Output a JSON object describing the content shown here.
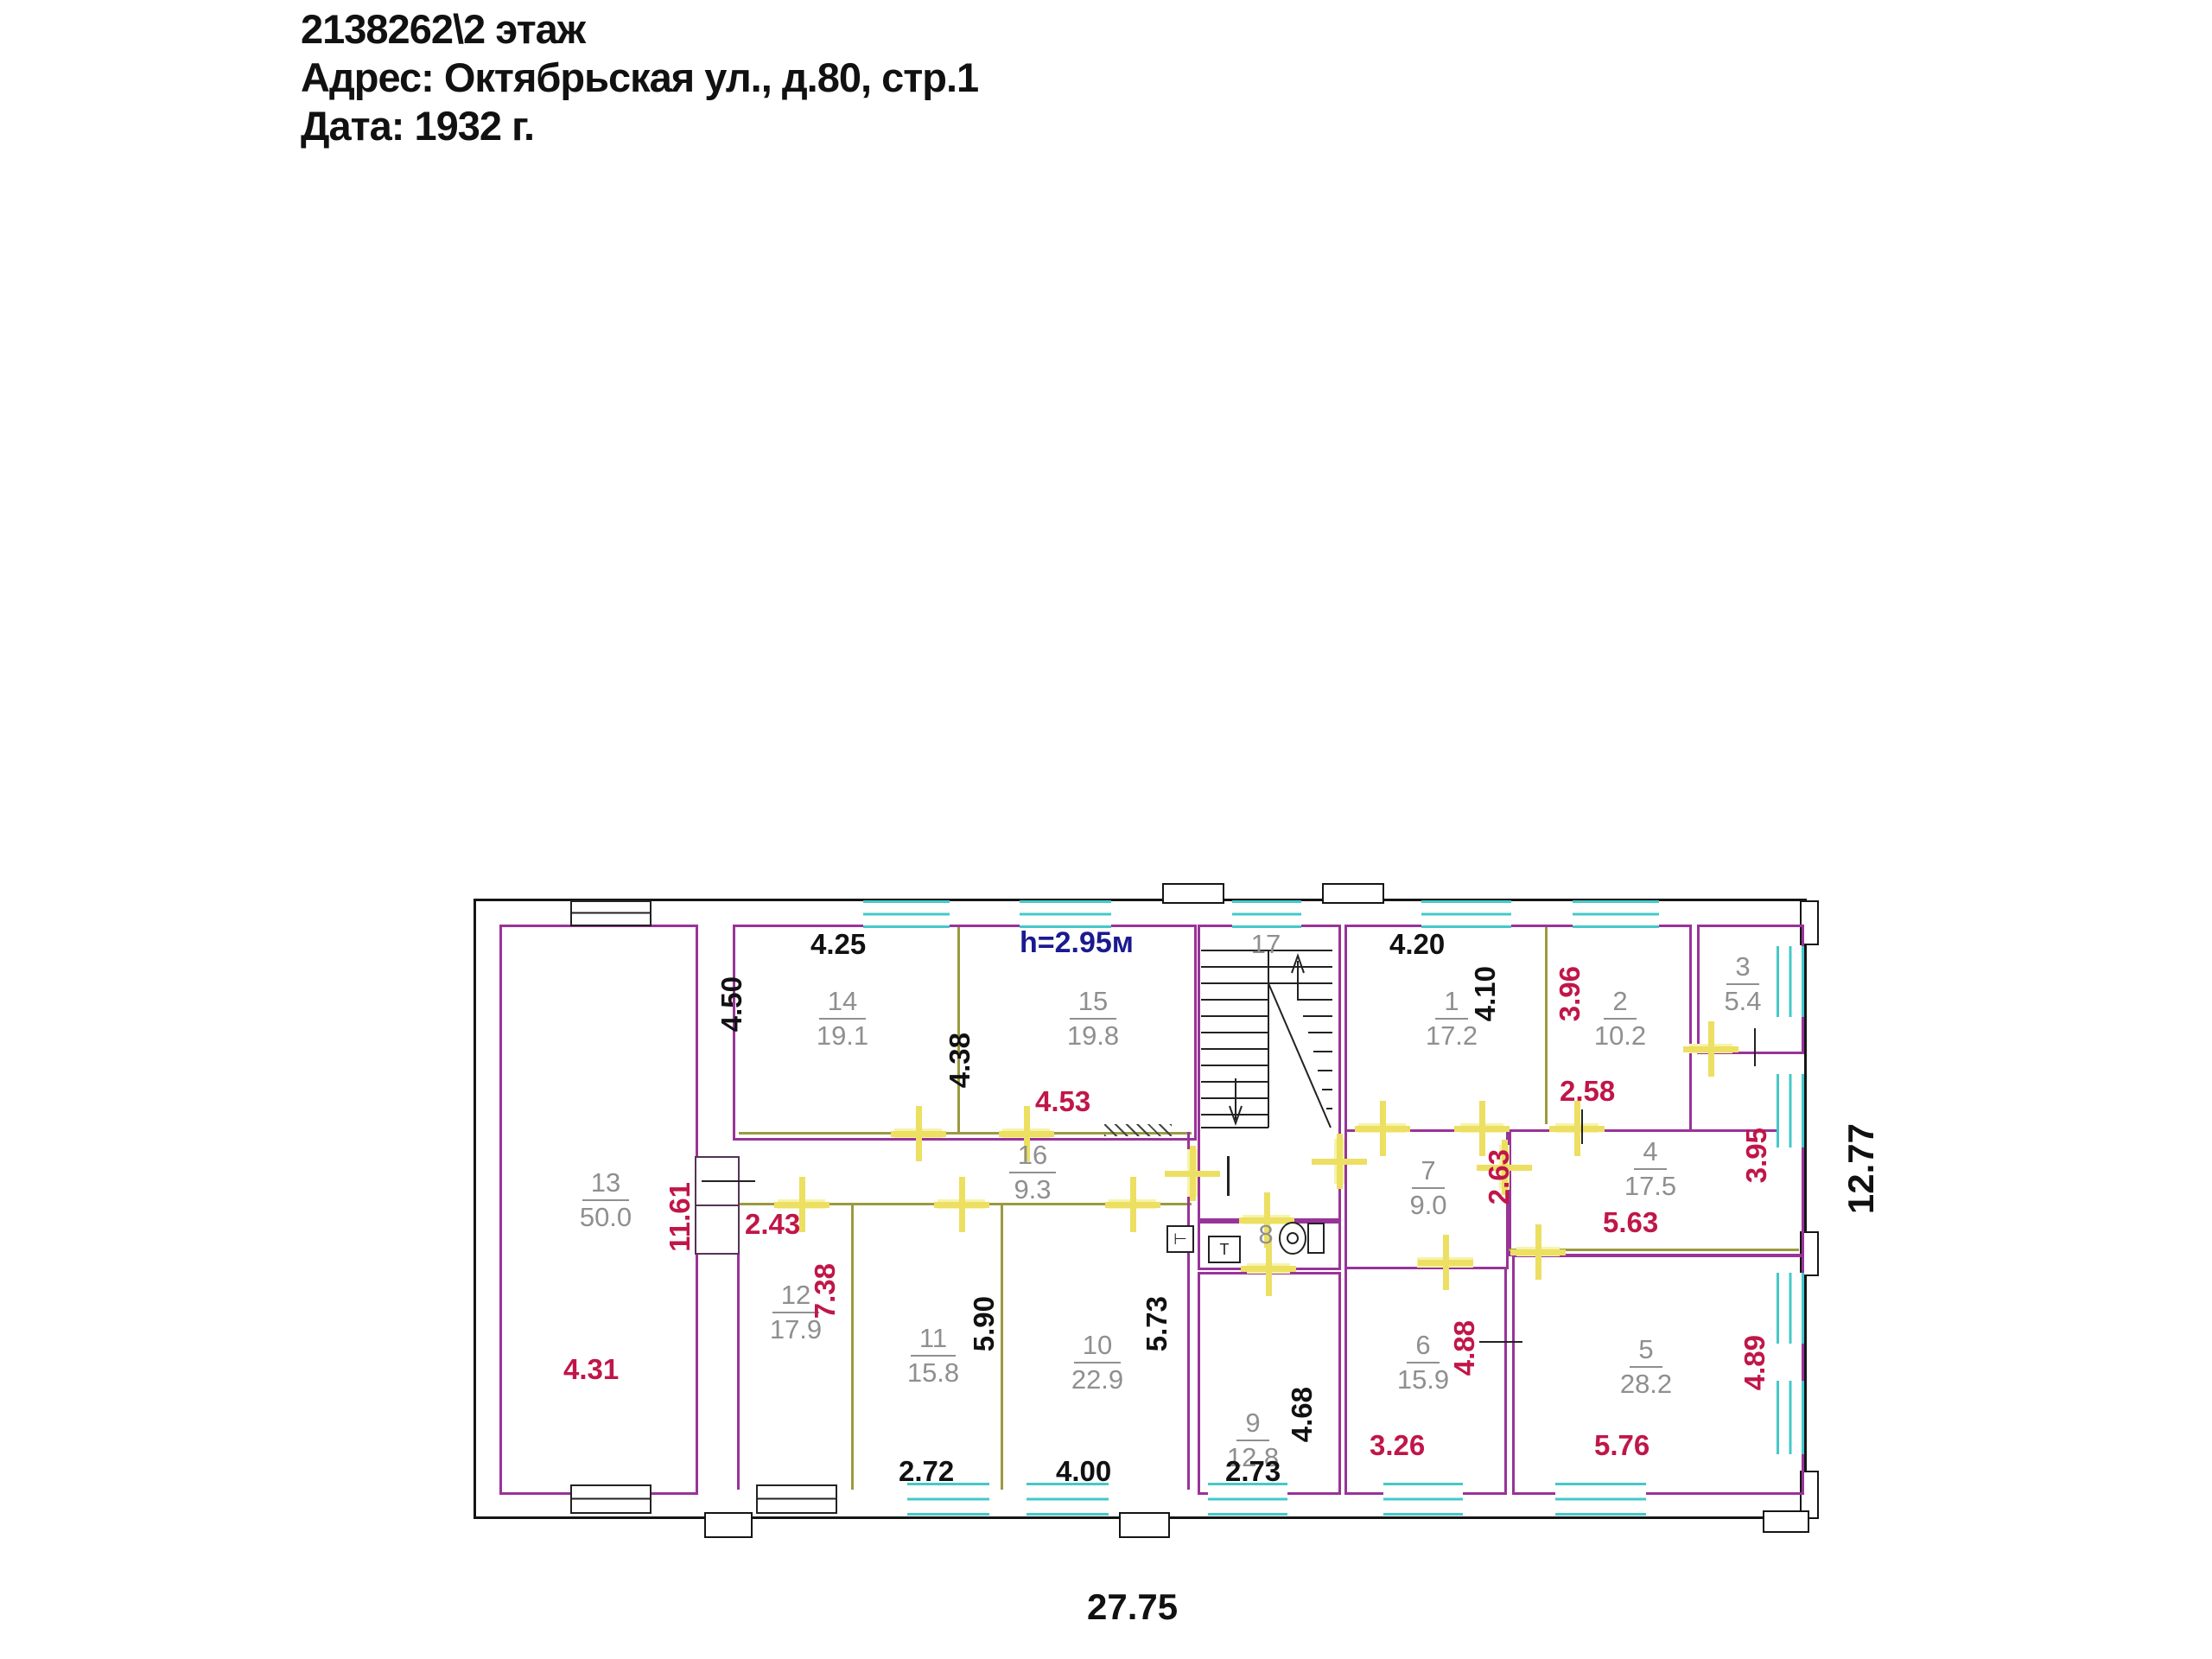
{
  "header": {
    "title": "2138262\\2 этаж",
    "address": "Адрес: Октябрьская ул., д.80, стр.1",
    "date": "Дата: 1932 г."
  },
  "plan": {
    "height_note": "h=2.95м",
    "total_width": "27.75",
    "total_height": "12.77",
    "colors": {
      "wall": "#993399",
      "partition": "#9a9a40",
      "window": "#45c8c8",
      "door": "#f7f3a8",
      "dim_red": "#c01648",
      "dim_black": "#111111",
      "room_label": "#8f8f8f",
      "note_blue": "#1a1a90"
    },
    "rooms": {
      "r1": {
        "number": "1",
        "area": "17.2"
      },
      "r2": {
        "number": "2",
        "area": "10.2"
      },
      "r3": {
        "number": "3",
        "area": "5.4"
      },
      "r4": {
        "number": "4",
        "area": "17.5"
      },
      "r5": {
        "number": "5",
        "area": "28.2"
      },
      "r6": {
        "number": "6",
        "area": "15.9"
      },
      "r7": {
        "number": "7",
        "area": "9.0"
      },
      "r8": {
        "number": "8"
      },
      "r9": {
        "number": "9",
        "area": "12.8"
      },
      "r10": {
        "number": "10",
        "area": "22.9"
      },
      "r11": {
        "number": "11",
        "area": "15.8"
      },
      "r12": {
        "number": "12",
        "area": "17.9"
      },
      "r13": {
        "number": "13",
        "area": "50.0"
      },
      "r14": {
        "number": "14",
        "area": "19.1"
      },
      "r15": {
        "number": "15",
        "area": "19.8"
      },
      "r16": {
        "number": "16",
        "area": "9.3"
      },
      "r17": {
        "number": "17"
      }
    },
    "dims": {
      "r14_top": "4.25",
      "r14_left": "4.50",
      "r15_left": "4.38",
      "r15_bottom": "4.53",
      "r1_top": "4.20",
      "r1_right": "4.10",
      "r2_left": "3.96",
      "r2_bottom": "2.58",
      "r4_left": "2.63",
      "r4_bottom": "5.63",
      "r4_right": "3.95",
      "r5_bottom": "5.76",
      "r5_right": "4.89",
      "r6_left": "4.88",
      "r6_bottom": "3.26",
      "r9_right": "4.68",
      "r9_bottom": "2.73",
      "r10_right": "5.73",
      "r10_bottom": "4.00",
      "r11_right": "5.90",
      "r11_bottom": "2.72",
      "r12_left": "7.38",
      "r12_top": "2.43",
      "r13_width": "4.31",
      "r13_right": "11.61"
    }
  }
}
